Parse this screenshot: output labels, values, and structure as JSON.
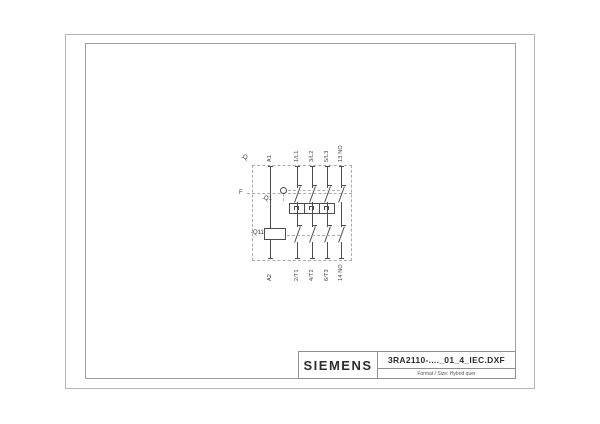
{
  "title_block": {
    "brand": "SIEMENS",
    "drawing_name": "3RA2110-...._01_4_IEC.DXF",
    "format_note": "Format / Size: Hybrid quer"
  },
  "schematic": {
    "assembly_label": "-Q",
    "function_line_label": "F",
    "breaker_label": "-Q1",
    "contactor_label": "-Q11",
    "top_terminals": [
      "A1",
      "1/L1",
      "3/L2",
      "5/L3",
      "13 NO"
    ],
    "bottom_terminals": [
      "A2",
      "2/T1",
      "4/T2",
      "6/T3",
      "14 NO"
    ],
    "colors": {
      "line": "#4d4d4d",
      "dashed": "#ababab",
      "frame": "#9e9e9e",
      "text": "#3a3a3a"
    }
  }
}
